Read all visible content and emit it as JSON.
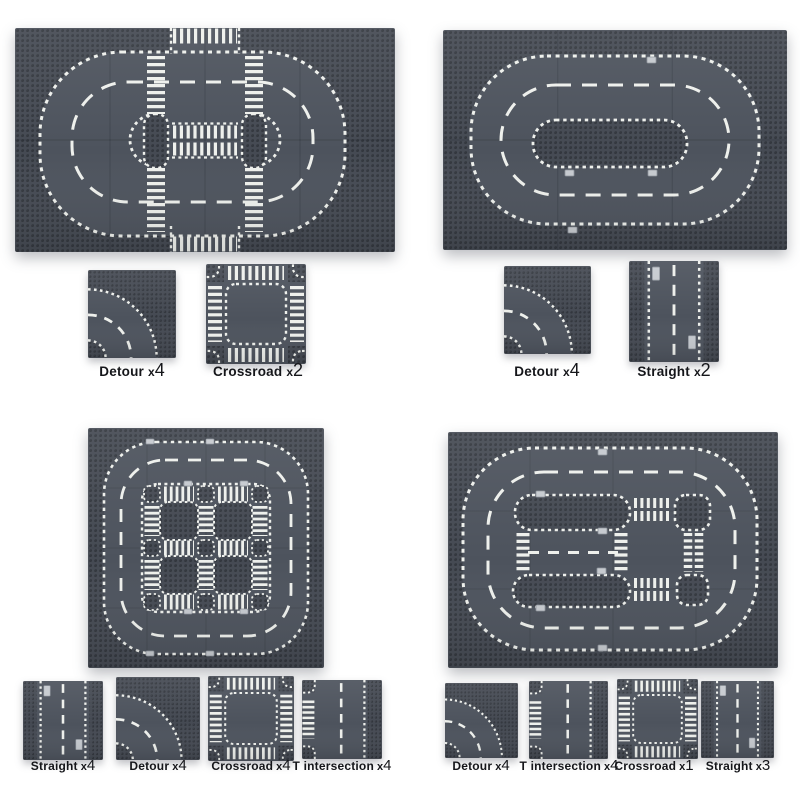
{
  "colors": {
    "background": "#ffffff",
    "plate_base": "#454a53",
    "stud_dot": "#31353c",
    "road_surface": "#4d535d",
    "road_marking": "#eef0ec",
    "manhole_tile": "#c6cacf",
    "label_text": "#15161a"
  },
  "sections": [
    {
      "id": "top-left",
      "pieces": [
        {
          "type": "detour",
          "name": "Detour",
          "times": "x",
          "count": "4"
        },
        {
          "type": "crossroad",
          "name": "Crossroad",
          "times": "x",
          "count": "2"
        }
      ]
    },
    {
      "id": "top-right",
      "pieces": [
        {
          "type": "detour",
          "name": "Detour",
          "times": "x",
          "count": "4"
        },
        {
          "type": "straight",
          "name": "Straight",
          "times": "x",
          "count": "2"
        }
      ]
    },
    {
      "id": "bottom-left",
      "pieces": [
        {
          "type": "straight",
          "name": "Straight",
          "times": "x",
          "count": "4"
        },
        {
          "type": "detour",
          "name": "Detour",
          "times": "x",
          "count": "4"
        },
        {
          "type": "crossroad",
          "name": "Crossroad",
          "times": "x",
          "count": "4"
        },
        {
          "type": "t-intersection",
          "name": "T intersection",
          "times": "x",
          "count": "4"
        }
      ]
    },
    {
      "id": "bottom-right",
      "pieces": [
        {
          "type": "detour",
          "name": "Detour",
          "times": "x",
          "count": "4"
        },
        {
          "type": "t-intersection",
          "name": "T intersection",
          "times": "x",
          "count": "4"
        },
        {
          "type": "crossroad",
          "name": "Crossroad",
          "times": "x",
          "count": "1"
        },
        {
          "type": "straight",
          "name": "Straight",
          "times": "x",
          "count": "3"
        }
      ]
    }
  ]
}
